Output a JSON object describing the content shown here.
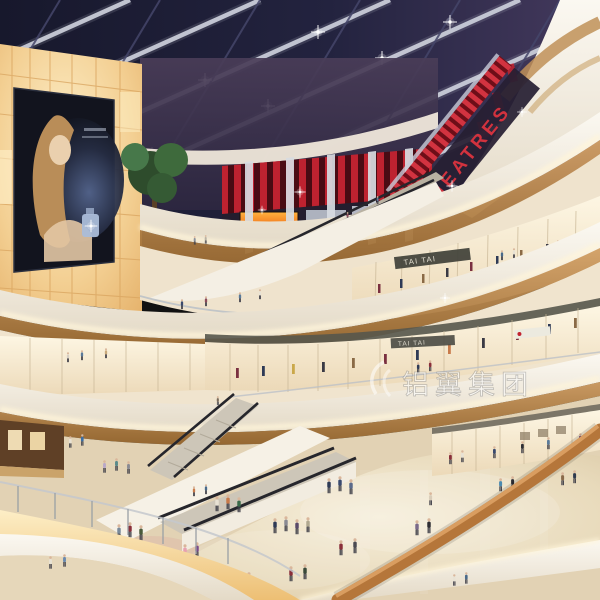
{
  "scene": {
    "type": "architectural-rendering",
    "setting": "multi-level shopping mall atrium interior at dusk"
  },
  "signs": {
    "theatres": "THEATRES",
    "tai_tai_upper": "TAI TAI",
    "tai_tai_lower": "TAI TAI"
  },
  "watermark": {
    "text": "铝翼集团"
  },
  "colors": {
    "sky": "#1d1e36",
    "sky_purple": "#3c3456",
    "beam": "#c9ccd8",
    "theatre_red": "#c2222f",
    "wall_glow": "#f6d79e",
    "billboard_bg": "#12141e",
    "fascia": "#f6f1e7",
    "wood": "#bd8a52",
    "shopfront": "#f9efd9",
    "floor": "#e6d8bd",
    "led_strip": "#fff6dc",
    "screen_orange": "#e8641e"
  }
}
